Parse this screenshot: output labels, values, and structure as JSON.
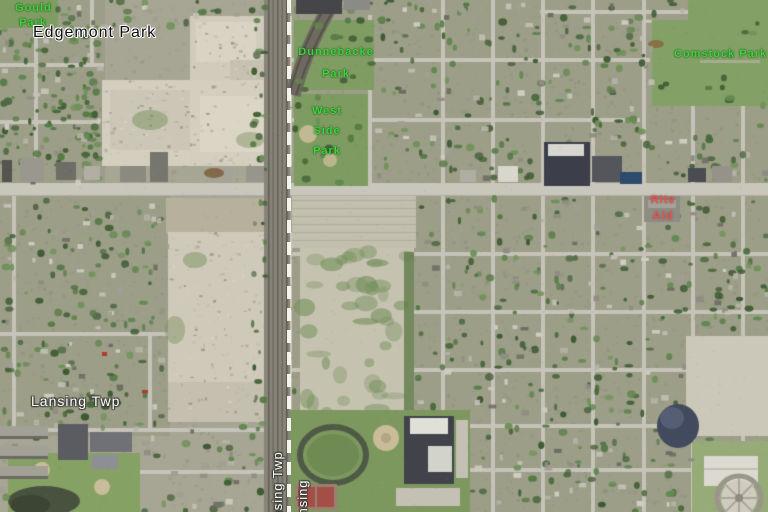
{
  "map": {
    "labels": {
      "gould_park": {
        "lines": [
          "Gould",
          "Park"
        ]
      },
      "edgemont_park": {
        "text": "Edgemont Park"
      },
      "dunnebacke_park": {
        "lines": [
          "Dunnebacke",
          "Park"
        ]
      },
      "west_side_park": {
        "lines": [
          "West",
          "Side",
          "Park"
        ]
      },
      "comstock_park": {
        "text": "Comstock Park"
      },
      "rite_aid": {
        "lines": [
          "Rite",
          "Aid"
        ]
      },
      "lansing_twp": {
        "text": "Lansing Twp"
      },
      "boundary_west": {
        "text": "Lansing Twp"
      },
      "boundary_east": {
        "text": "Lansing"
      }
    },
    "label_colors": {
      "park": "#3cd43c",
      "place": "#0d0d0d",
      "municipal": "#ffffff",
      "poi": "#e8544b"
    },
    "boundary": {
      "color": "#f4f4ee"
    }
  }
}
